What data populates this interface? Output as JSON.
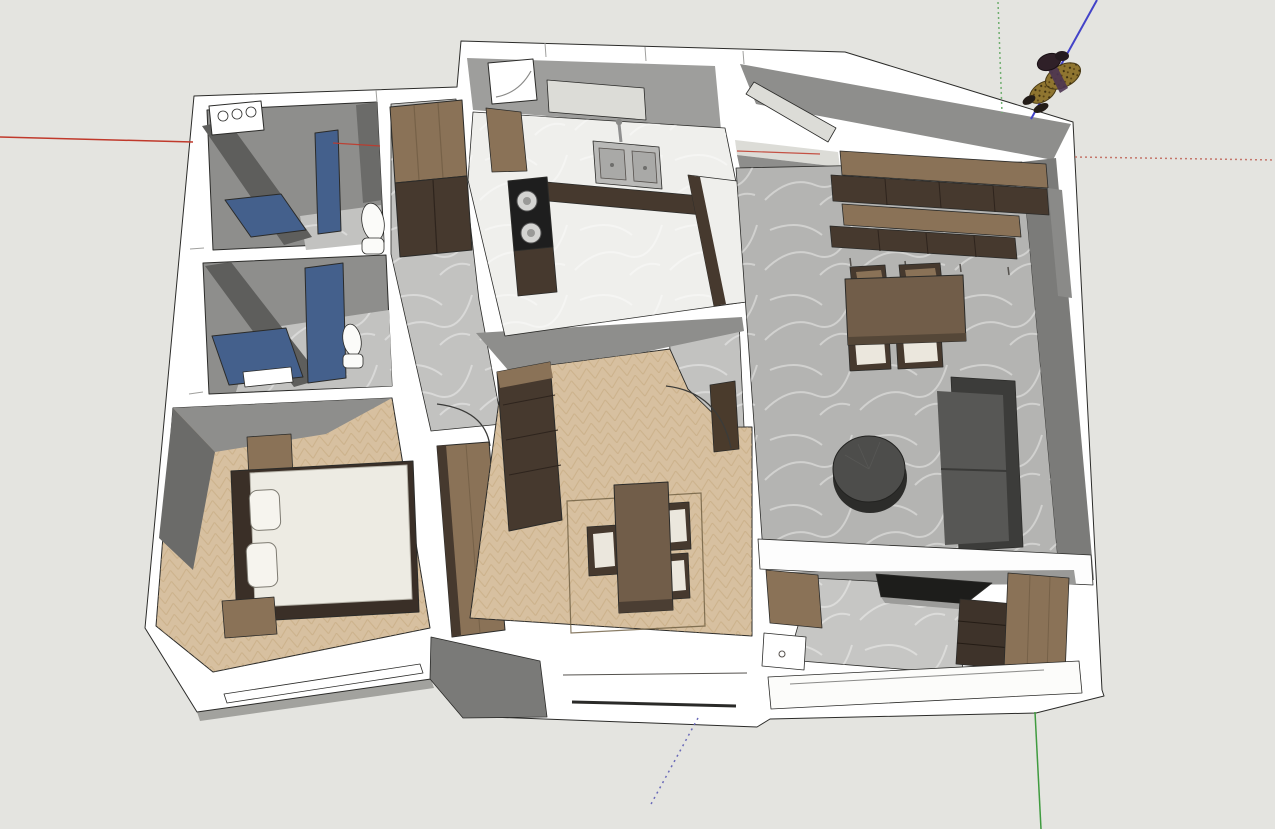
{
  "scene": {
    "type": "3d-model-viewport",
    "style": "SketchUp-like shaded 3D view, no toolbars visible",
    "subject": "Apartment interior 3D floor-plan model viewed from above",
    "background_note": "empty light-gray modeling space around the model"
  },
  "axes": {
    "red": {
      "solid_direction": "left",
      "dotted_direction": "right"
    },
    "green": {
      "solid_direction": "bottom",
      "dotted_direction": "top"
    },
    "blue": {
      "solid_direction": "upper-right",
      "dotted_direction": "lower-left"
    }
  },
  "figure": {
    "label": "Scale figure (person seen from above)",
    "location": "floating outside the model, top-right, on the blue axis"
  },
  "rooms": [
    {
      "id": "bathroom-1",
      "label": "Bathroom / Laundry (top-left)",
      "floor": "gray marble tile",
      "furniture": [
        "washing machine with 3 dials",
        "blue glass shower panels",
        "toilet"
      ]
    },
    {
      "id": "bathroom-2",
      "label": "Bathroom 2 (mid-left)",
      "floor": "gray marble tile",
      "furniture": [
        "blue glass shower panels",
        "toilet",
        "white shelf"
      ]
    },
    {
      "id": "hallway",
      "label": "Hallway",
      "floor": "gray marble tile",
      "furniture": [
        "tall wood cabinet"
      ]
    },
    {
      "id": "kitchen",
      "label": "Kitchen (top-center)",
      "floor": "white marble",
      "furniture": [
        "corner unit",
        "double steel sink with faucet",
        "black cooktop with two burners",
        "dark base cabinets",
        "marble peninsula",
        "window"
      ]
    },
    {
      "id": "bedroom",
      "label": "Bedroom (bottom-left)",
      "floor": "herringbone wood",
      "furniture": [
        "double bed with white duvet",
        "two pillows",
        "two nightstands",
        "wardrobe",
        "door swing"
      ]
    },
    {
      "id": "room-2",
      "label": "Second room (center)",
      "floor": "herringbone wood",
      "furniture": [
        "wardrobe",
        "small table",
        "three chairs with cream cushions",
        "rug outline",
        "door with swing arc"
      ]
    },
    {
      "id": "living-dining",
      "label": "Living / Dining room (right)",
      "floor": "gray concrete",
      "furniture": [
        "long wall cabinet unit (two wood shelves, dark fronts)",
        "dining table",
        "four chairs",
        "round dark coffee table",
        "gray sofa"
      ]
    },
    {
      "id": "utility-wall",
      "label": "Lower utility / TV wall (bottom-right)",
      "floor": "gray marble counter",
      "furniture": [
        "wood cabinets",
        "white sink box",
        "dark TV panel",
        "dark drawer stack",
        "parapet wall"
      ]
    }
  ],
  "palette": {
    "bg": "#e4e4e0",
    "line": "#2b2b29",
    "white": "#ffffff",
    "wallMid": "#8e8e8c",
    "wallDark": "#5e5e5c",
    "wallDark2": "#6b6b69",
    "wallLight": "#9e9e9c",
    "shadow": "#a2a29e",
    "tile": "#c2c2c0",
    "marble": "#efefec",
    "concrete": "#b4b4b2",
    "winlight": "#dcdcd7",
    "wood": "#d7c0a0",
    "woodCab": "#8a7257",
    "cabDark": "#46392e",
    "tableWood": "#715d49",
    "duvet": "#edebe3",
    "cushion": "#ebe7dd",
    "bedframe": "#3a2f27",
    "sofaBack": "#3c3c3a",
    "sofaSeat": "#575755",
    "dark": "#1e1e1e",
    "steel": "#b9b9b7",
    "glass": "#44608c",
    "toiletWhite": "#fbfbf9",
    "axisRed": "#c0392b",
    "axisRedNeg": "#c4756a",
    "axisGreen": "#3f9b3f",
    "axisGreenNeg": "#6fae6f",
    "axisBlue": "#4343c8",
    "axisBlueNeg": "#6a6ab8",
    "figBody": "#8f7530",
    "figDark": "#2f2028"
  }
}
